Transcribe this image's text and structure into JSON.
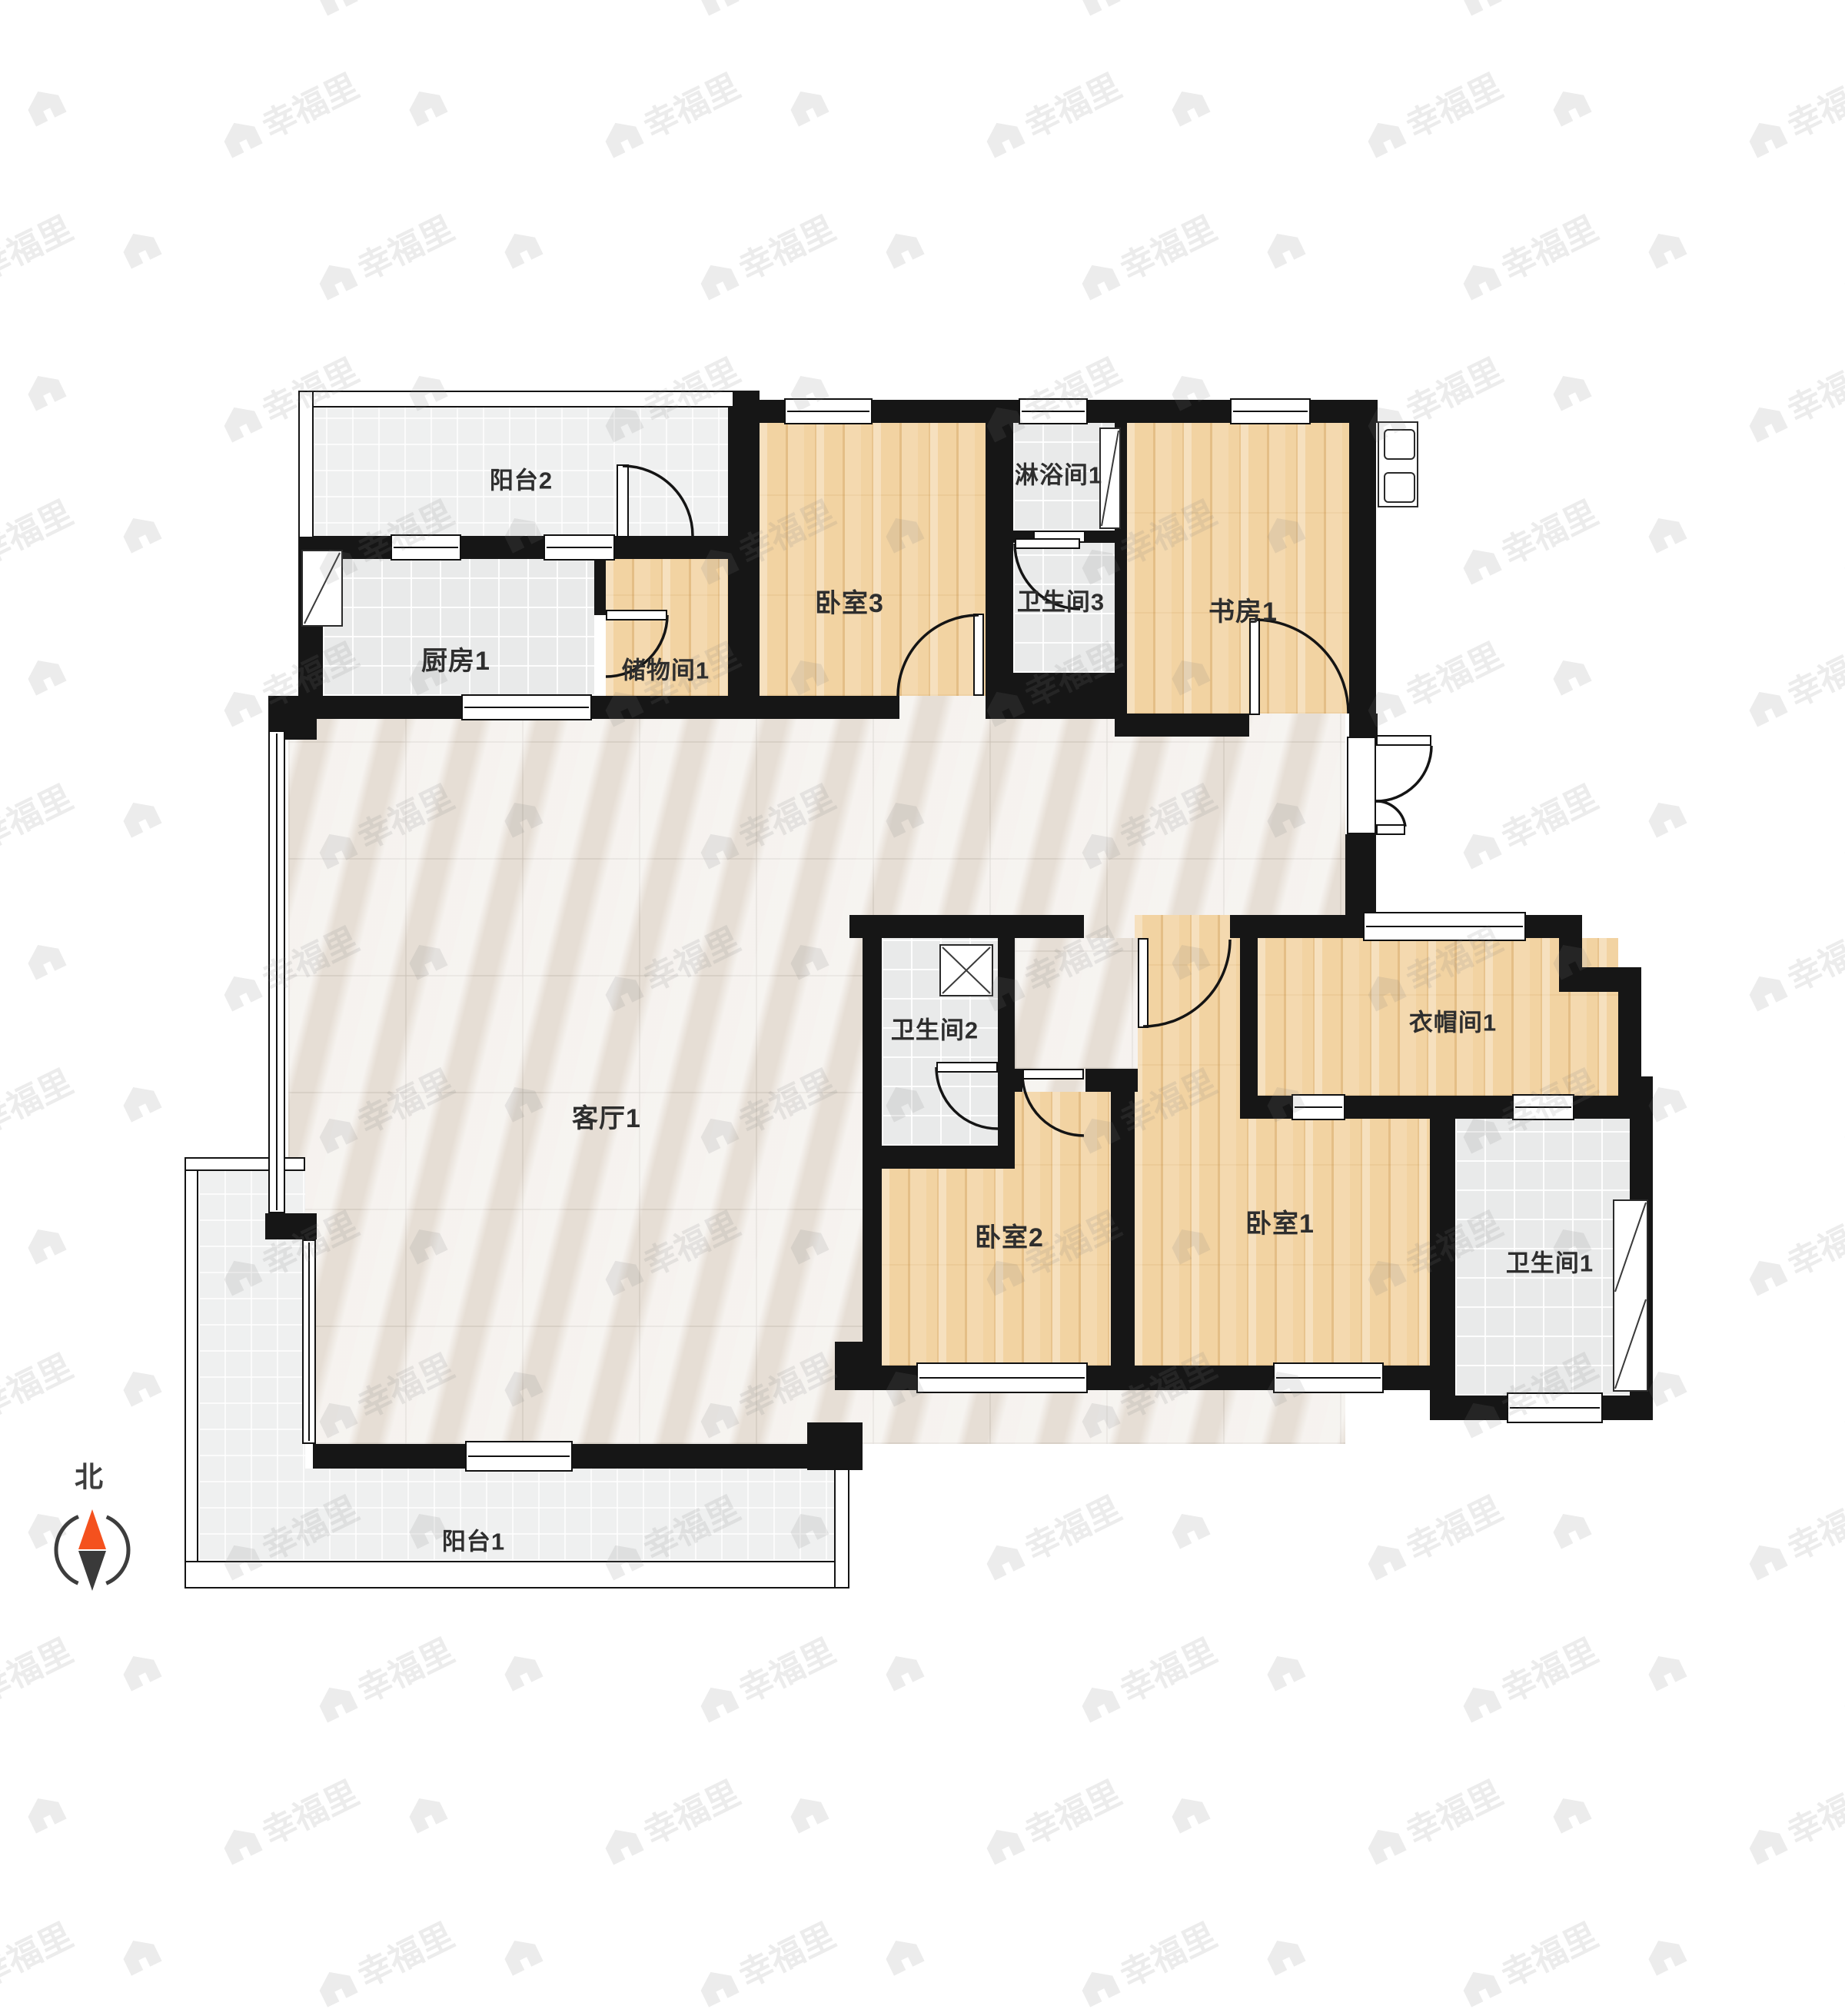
{
  "watermark": {
    "text": "幸福里"
  },
  "compass": {
    "label": "北"
  },
  "rooms": {
    "balcony2": {
      "label": "阳台2"
    },
    "kitchen1": {
      "label": "厨房1"
    },
    "storage1": {
      "label": "储物间1"
    },
    "bedroom3": {
      "label": "卧室3"
    },
    "shower1": {
      "label": "淋浴间1"
    },
    "bath3": {
      "label": "卫生间3"
    },
    "study1": {
      "label": "书房1"
    },
    "living1": {
      "label": "客厅1"
    },
    "bath2": {
      "label": "卫生间2"
    },
    "bedroom2": {
      "label": "卧室2"
    },
    "bedroom1": {
      "label": "卧室1"
    },
    "cloak1": {
      "label": "衣帽间1"
    },
    "bath1": {
      "label": "卫生间1"
    },
    "balcony1": {
      "label": "阳台1"
    }
  }
}
